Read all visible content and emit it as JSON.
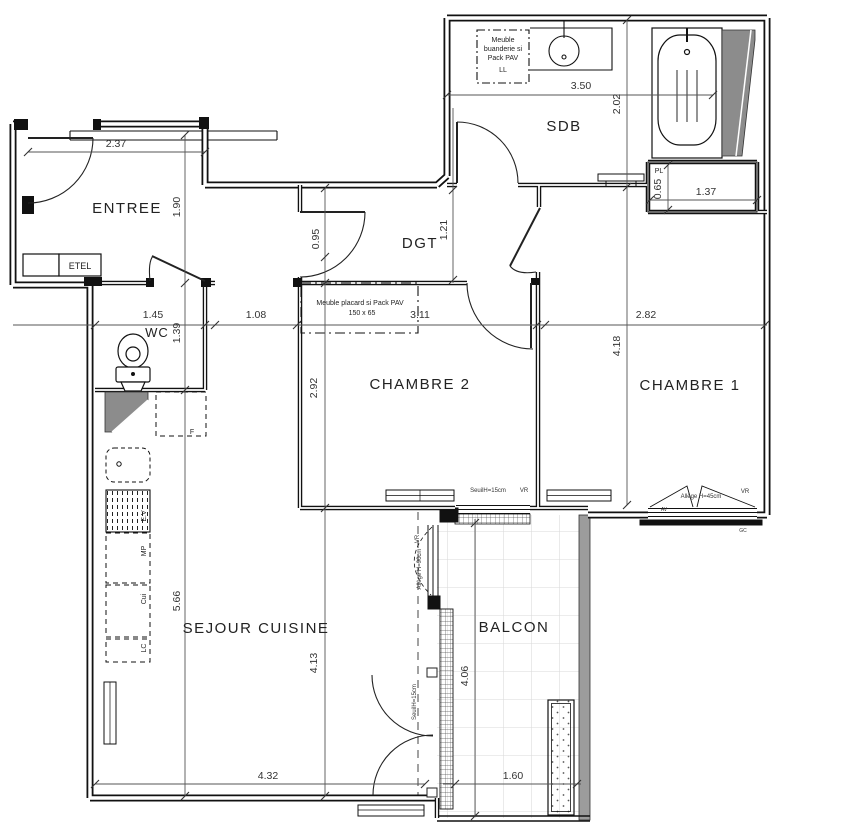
{
  "plan": {
    "rooms": {
      "entree": "ENTREE",
      "sdb": "SDB",
      "dgt": "DGT",
      "wc": "WC",
      "chambre2": "CHAMBRE 2",
      "chambre1": "CHAMBRE 1",
      "sejour": "SEJOUR CUISINE",
      "balcon": "BALCON"
    },
    "fixtures": {
      "etel": "ETEL",
      "buanderie_line1": "Meuble",
      "buanderie_line2": "buanderie si",
      "buanderie_line3": "Pack PAV",
      "buanderie_line4": "LL",
      "placard_line1": "Meuble placard si Pack PAV",
      "placard_line2": "150 x  65",
      "pl": "PL",
      "fridge": "F",
      "ev": "E.V",
      "mp": "MP",
      "cui": "Cui",
      "lc": "LC"
    },
    "windows": {
      "seuil15": "SeuilH=15cm",
      "vr": "VR",
      "allege45": "Allège H=45cm",
      "allege90": "Allège H=90cm",
      "av": "AV",
      "gc": "GC"
    },
    "dims": {
      "entree_width": "2.37",
      "entree_depth": "1.90",
      "dgt_left": "0.95",
      "dgt_right": "1.21",
      "sdb_width": "3.50",
      "sdb_depth": "2.02",
      "pl_depth": "0.65",
      "pl_width": "1.37",
      "wc_width": "1.45",
      "wc_depth": "1.39",
      "passage": "1.08",
      "chambre2_width": "3.11",
      "chambre1_width": "2.82",
      "chambre1_depth": "4.18",
      "chambre2_depth": "2.92",
      "sejour_height": "5.66",
      "sejour_depth": "4.13",
      "sejour_width": "4.32",
      "balcon_depth": "4.06",
      "balcon_width": "1.60"
    },
    "colors": {
      "wall": "#111111",
      "shaft_gray": "#8c8c8c",
      "parapet_gray": "#9c9c9c",
      "tile_gray": "#d9d9d9"
    }
  }
}
